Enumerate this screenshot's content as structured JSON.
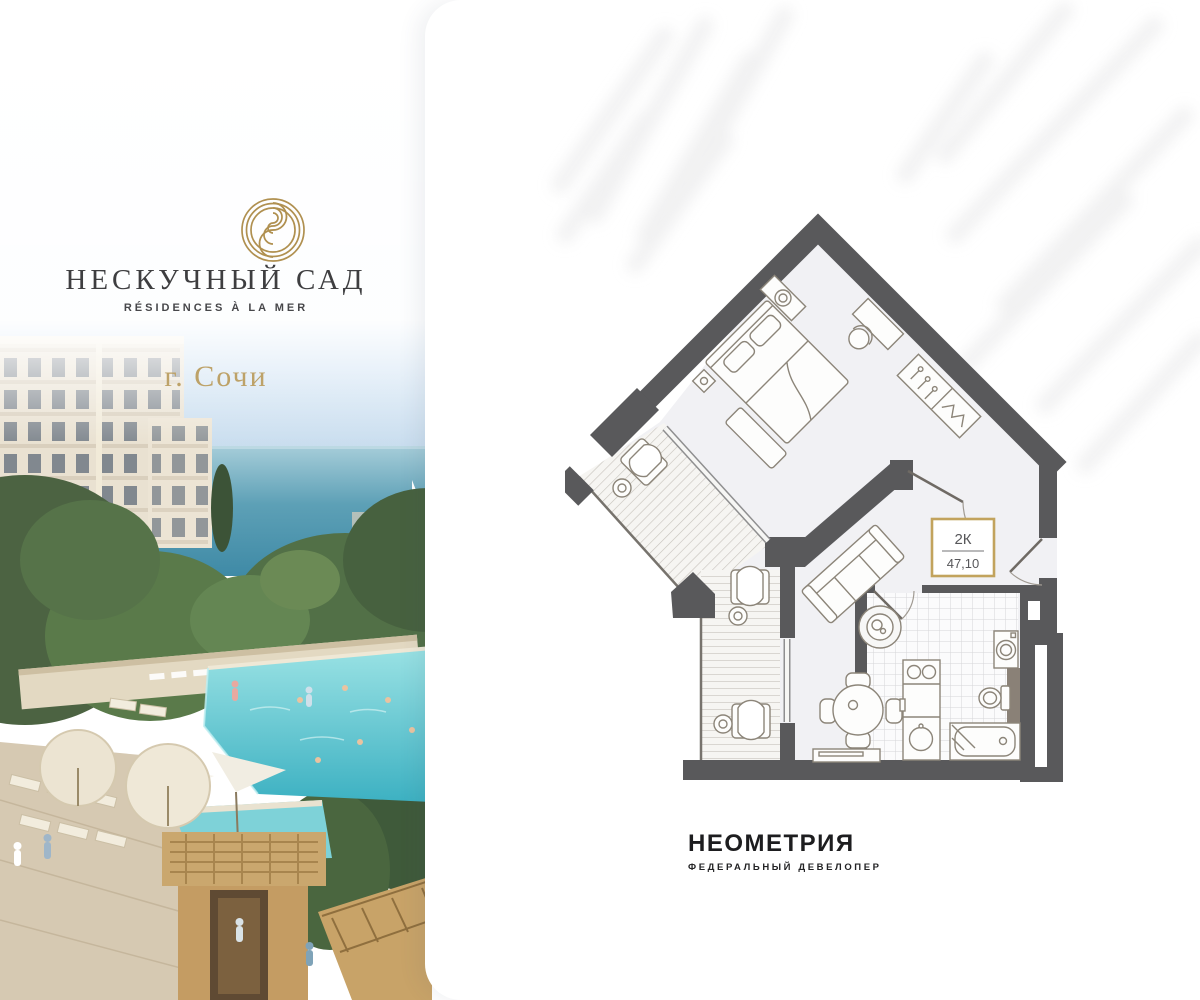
{
  "brand": {
    "name": "НЕСКУЧНЫЙ САД",
    "tagline": "RÉSIDENCES À LA MER",
    "city": "г. Сочи",
    "logo_icon": "spiral-rings-icon"
  },
  "floor_plan": {
    "badge": {
      "room_type": "2К",
      "area": "47,10"
    }
  },
  "developer": {
    "name": "НЕОМЕТРИЯ",
    "subtitle": "ФЕДЕРАЛЬНЫЙ ДЕВЕЛОПЕР"
  },
  "colors": {
    "accent_gold": "#c2a35d",
    "brand_gold": "#b09050",
    "plan_walls": "#59595b",
    "city_text": "#bda268",
    "pool_water": "#4fc3cd",
    "sea_water": "#4f97b0"
  }
}
